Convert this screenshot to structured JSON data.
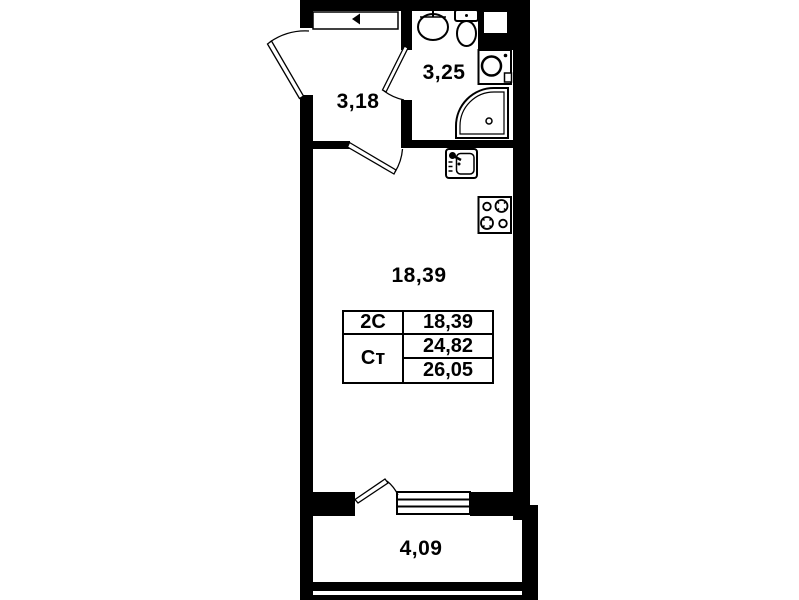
{
  "plan": {
    "colors": {
      "wall": "#000000",
      "background": "#ffffff"
    },
    "rooms": [
      {
        "name": "hallway",
        "area": "3,18"
      },
      {
        "name": "bathroom",
        "area": "3,25"
      },
      {
        "name": "living-kitchen",
        "area": "18,39"
      },
      {
        "name": "balcony",
        "area": "4,09"
      }
    ],
    "legend": {
      "rows": [
        {
          "type": "2С",
          "area": "18,39"
        },
        {
          "type": "Ст",
          "area": "24,82"
        },
        {
          "area": "26,05"
        }
      ]
    },
    "fixtures": [
      "entrance-door-marker-icon",
      "sink-icon",
      "toilet-icon",
      "washing-machine-icon",
      "shower-icon",
      "kitchen-sink-icon",
      "stove-icon",
      "interior-door-icon",
      "balcony-window-icon"
    ]
  }
}
